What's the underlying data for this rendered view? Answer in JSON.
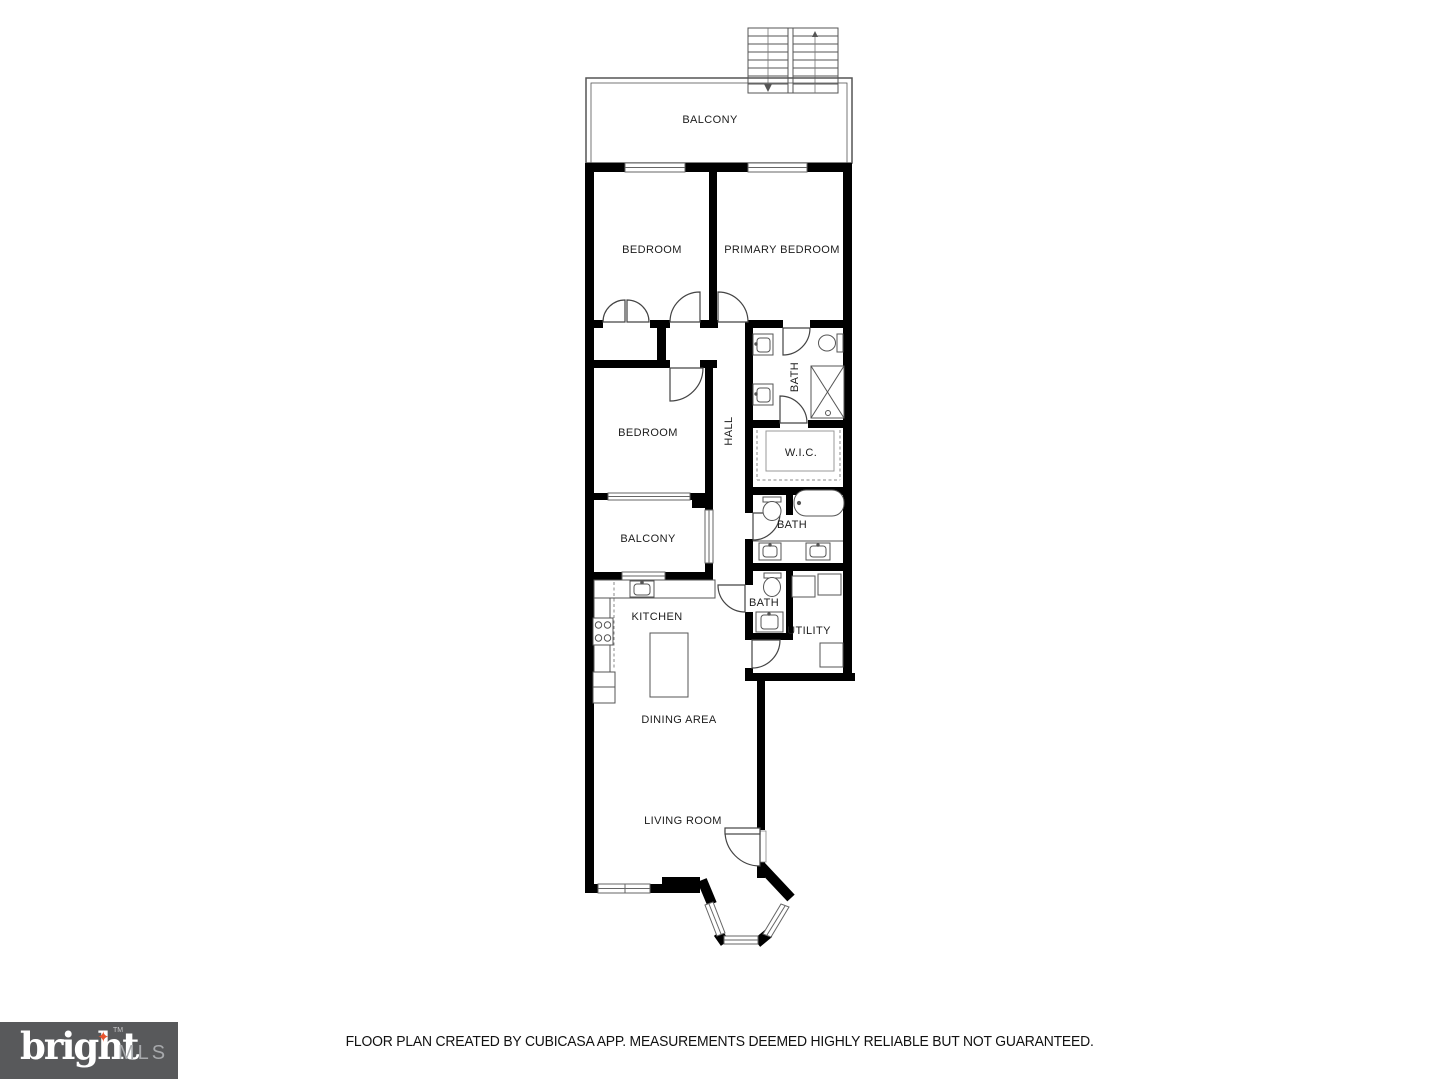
{
  "page": {
    "background": "#ffffff"
  },
  "rooms": {
    "balcony_top": {
      "label": "BALCONY"
    },
    "bedroom_top": {
      "label": "BEDROOM"
    },
    "primary_bedroom": {
      "label": "PRIMARY BEDROOM"
    },
    "bedroom_mid": {
      "label": "BEDROOM"
    },
    "hall": {
      "label": "HALL"
    },
    "bath_primary": {
      "label": "BATH"
    },
    "wic": {
      "label": "W.I.C."
    },
    "balcony_mid": {
      "label": "BALCONY"
    },
    "bath_mid": {
      "label": "BATH"
    },
    "kitchen": {
      "label": "KITCHEN"
    },
    "bath_lower": {
      "label": "BATH"
    },
    "utility": {
      "label": "UTILITY"
    },
    "dining": {
      "label": "DINING AREA"
    },
    "living": {
      "label": "LIVING ROOM"
    }
  },
  "footer": {
    "disclaimer": "FLOOR PLAN CREATED BY CUBICASA APP. MEASUREMENTS DEEMED HIGHLY RELIABLE BUT NOT GUARANTEED."
  },
  "logo": {
    "brand": "bright",
    "suffix": "MLS",
    "trademark": "TM",
    "star_glyph": "✦",
    "background": "#58595b",
    "brand_color": "#ffffff",
    "suffix_color": "#a7a9ac",
    "star_color": "#e8542e"
  },
  "colors": {
    "wall": "#000000",
    "fixture_line": "#555555",
    "window_line": "#666666",
    "label_text": "#1c1c1c"
  }
}
